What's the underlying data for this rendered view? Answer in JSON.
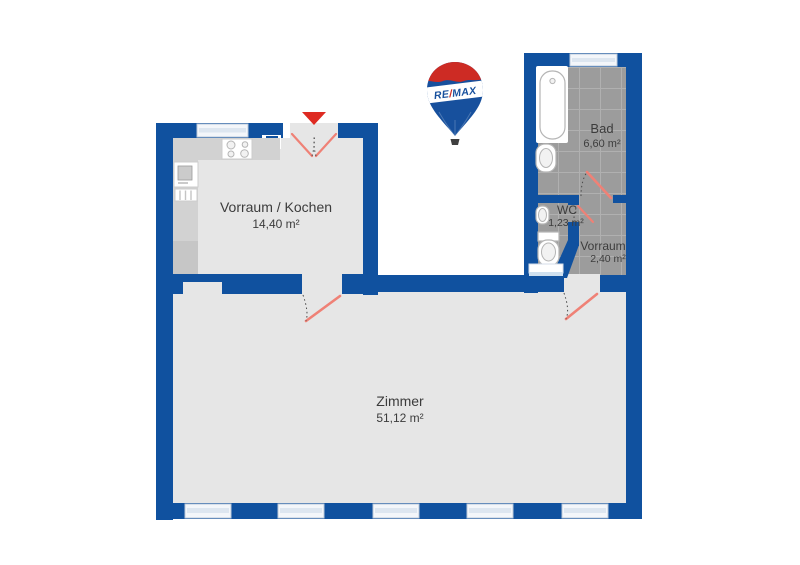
{
  "branding": {
    "logo_re": "RE",
    "logo_slash": "/",
    "logo_max": "MAX",
    "logo_name": "remax-balloon"
  },
  "rooms": [
    {
      "id": "vorraum-kochen",
      "name": "Vorraum / Kochen",
      "area": "14,40 m²"
    },
    {
      "id": "bad",
      "name": "Bad",
      "area": "6,60 m²"
    },
    {
      "id": "wc",
      "name": "WC",
      "area": "1,23 m²"
    },
    {
      "id": "vorraum",
      "name": "Vorraum",
      "area": "2,40 m²"
    },
    {
      "id": "zimmer",
      "name": "Zimmer",
      "area": "51,12 m²"
    }
  ],
  "fixtures": [
    "bathtub",
    "bathroom-sink",
    "wc-sink",
    "toilet",
    "shelf",
    "kitchen-counter",
    "stove",
    "kitchen-sink-unit",
    "radiator",
    "entrance-arrow",
    "door-swing",
    "window"
  ],
  "colors": {
    "wall": "#10519f",
    "floor": "#e6e6e6",
    "tile": "#9c9c9c",
    "tile_line": "#b0b0b0",
    "counter": "#d2d2d2",
    "counter_dark": "#c6c6c6",
    "fixture_line": "#b5b5b5",
    "window_fill": "#f3f6fa",
    "window_line": "#bcc9d9",
    "window_mid": "#dde6f0",
    "door_red": "#ef8176",
    "accent_red": "#de2b22",
    "balloon_blue": "#17509d",
    "balloon_red": "#cd2b24",
    "dash": "#4a4a4a",
    "text": "#3c3c3c"
  }
}
